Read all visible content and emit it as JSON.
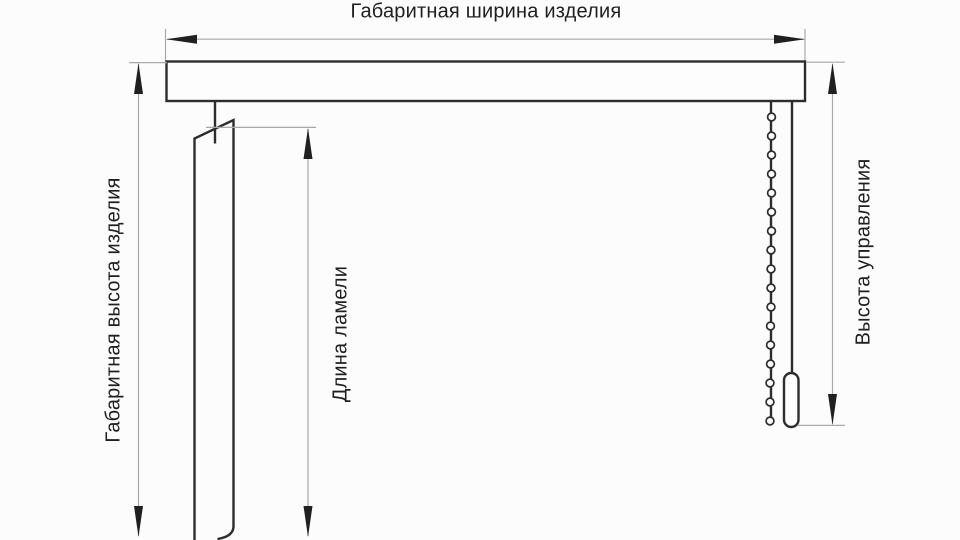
{
  "diagram": {
    "kind": "vertical-blinds-measurement-scheme",
    "dimension_labels": {
      "overall_width": "Габаритная ширина изделия",
      "overall_height": "Габаритная высота изделия",
      "slat_length": "Длина ламели",
      "control_height": "Высота управления"
    },
    "components": [
      "headrail",
      "slat",
      "hanger-pin",
      "ball-chain",
      "chain-weight"
    ],
    "colors": {
      "background": "#fcfcfc",
      "outline": "#2d2d2d",
      "dimension_line": "#a8a8a8",
      "arrowhead": "#202020",
      "text": "#1f1f1f"
    }
  }
}
